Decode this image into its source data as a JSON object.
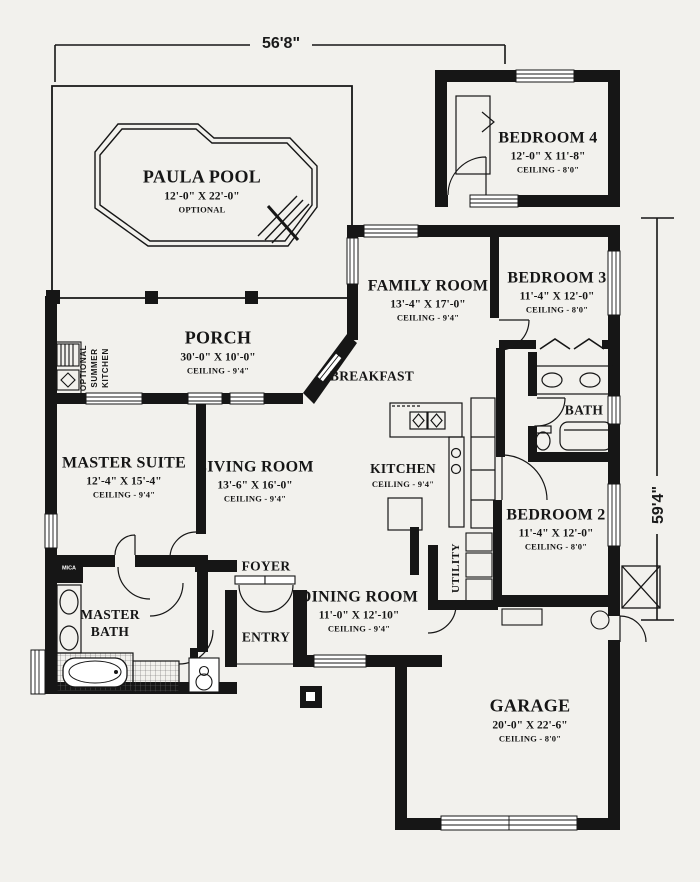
{
  "plan": {
    "paper_color": "#f2f1ed",
    "ink_color": "#161616",
    "dimensions": {
      "width_label": "56'8\"",
      "height_label": "59'4\""
    },
    "rooms": {
      "pool": {
        "name": "PAULA POOL",
        "dims": "12'-0\" X 22'-0\"",
        "note": "OPTIONAL"
      },
      "bedroom4": {
        "name": "BEDROOM 4",
        "dims": "12'-0\" X 11'-8\"",
        "ceiling": "CEILING - 8'0\""
      },
      "family_room": {
        "name": "FAMILY ROOM",
        "dims": "13'-4\" X 17'-0\"",
        "ceiling": "CEILING - 9'4\""
      },
      "bedroom3": {
        "name": "BEDROOM 3",
        "dims": "11'-4\" X 12'-0\"",
        "ceiling": "CEILING - 8'0\""
      },
      "porch": {
        "name": "PORCH",
        "dims": "30'-0\" X 10'-0\"",
        "ceiling": "CEILING - 9'4\""
      },
      "summer_kitchen": {
        "line1": "OPTIONAL",
        "line2": "SUMMER",
        "line3": "KITCHEN"
      },
      "breakfast": {
        "name": "BREAKFAST"
      },
      "bath": {
        "name": "BATH"
      },
      "master_suite": {
        "name": "MASTER SUITE",
        "dims": "12'-4\" X 15'-4\"",
        "ceiling": "CEILING - 9'4\""
      },
      "living_room": {
        "name": "LIVING ROOM",
        "dims": "13'-6\" X 16'-0\"",
        "ceiling": "CEILING - 9'4\""
      },
      "kitchen": {
        "name": "KITCHEN",
        "ceiling": "CEILING - 9'4\""
      },
      "bedroom2": {
        "name": "BEDROOM 2",
        "dims": "11'-4\" X 12'-0\"",
        "ceiling": "CEILING - 8'0\""
      },
      "foyer": {
        "name": "FOYER"
      },
      "entry": {
        "name": "ENTRY"
      },
      "dining_room": {
        "name": "DINING ROOM",
        "dims": "11'-0\" X 12'-10\"",
        "ceiling": "CEILING - 9'4\""
      },
      "utility": {
        "name": "UTILITY"
      },
      "master_bath": {
        "line1": "MASTER",
        "line2": "BATH"
      },
      "garage": {
        "name": "GARAGE",
        "dims": "20'-0\" X 22'-6\"",
        "ceiling": "CEILING - 8'0\""
      },
      "cabinet_label": "MICA"
    }
  }
}
